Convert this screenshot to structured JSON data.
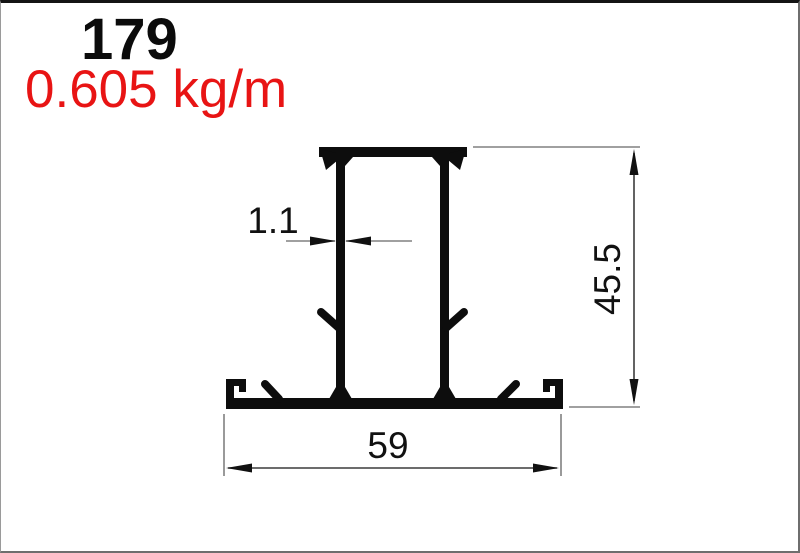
{
  "header": {
    "profile_number": "179",
    "weight": "0.605 kg/m"
  },
  "drawing": {
    "kind": "aluminium-extrusion-profile-cross-section",
    "dimensions": {
      "wall_thickness_mm": "1.1",
      "height_mm": "45.5",
      "width_mm": "59"
    },
    "colors": {
      "profile_black": "#0d0d0d",
      "weight_red": "#e81414",
      "leader_line_gray": "#808080",
      "dimension_line_gray": "#3c3c3c",
      "text_black": "#111111"
    }
  }
}
